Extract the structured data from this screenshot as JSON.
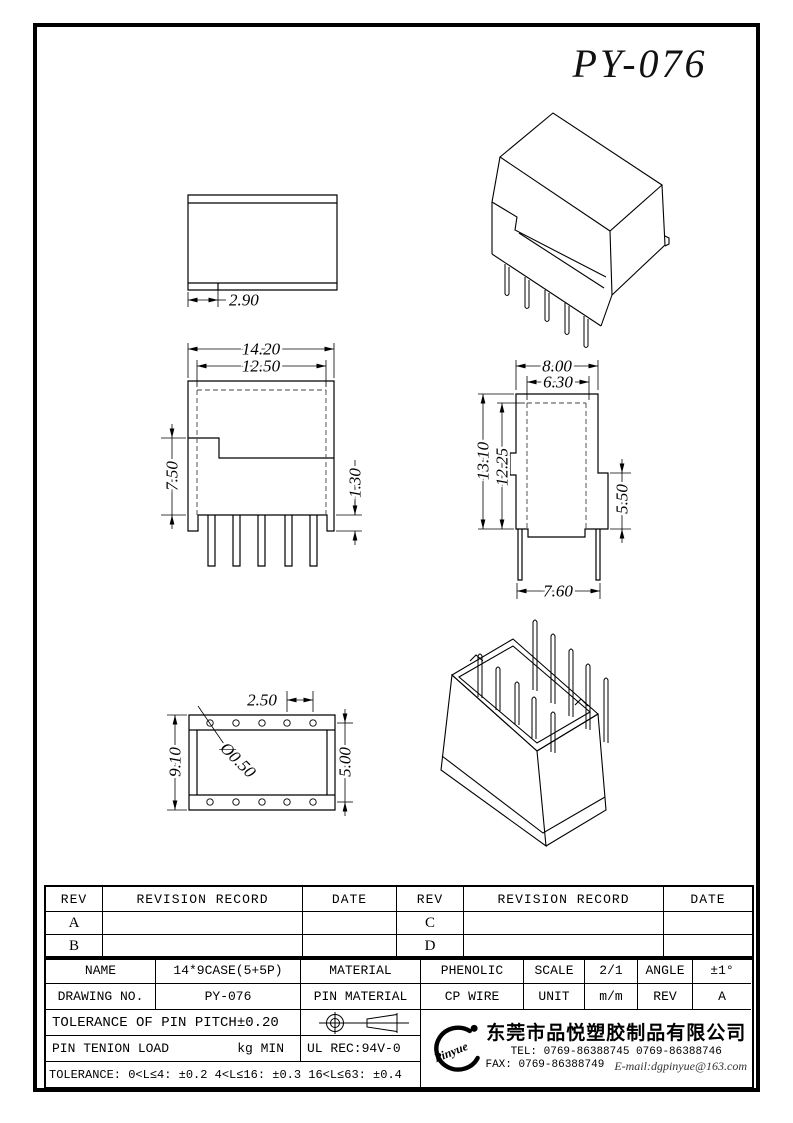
{
  "title": "PY-076",
  "views": {
    "top_view": {
      "step_width": "2.90"
    },
    "front_view": {
      "outer_width": "14.20",
      "inner_width": "12.50",
      "left_height": "7.50",
      "lip_height": "1.30"
    },
    "side_view": {
      "outer_width": "8.00",
      "inner_width": "6.30",
      "total_height": "13.10",
      "inner_height": "12.25",
      "right_height": "5.50",
      "pin_span": "7.60"
    },
    "bottom_view": {
      "pin_pitch": "2.50",
      "hole_diameter": "Ø0.50",
      "height": "9.10",
      "row_span": "5.00"
    }
  },
  "revision_table": {
    "headers": [
      "REV",
      "REVISION RECORD",
      "DATE",
      "REV",
      "REVISION RECORD",
      "DATE"
    ],
    "rows": [
      [
        "A",
        "",
        "",
        "C",
        "",
        ""
      ],
      [
        "B",
        "",
        "",
        "D",
        "",
        ""
      ]
    ]
  },
  "title_block": {
    "name_label": "NAME",
    "name_value": "14*9CASE(5+5P)",
    "material_label": "MATERIAL",
    "material_value": "PHENOLIC",
    "scale_label": "SCALE",
    "scale_value": "2/1",
    "angle_label": "ANGLE",
    "angle_value": "±1°",
    "drawing_no_label": "DRAWING NO.",
    "drawing_no_value": "PY-076",
    "pin_material_label": "PIN MATERIAL",
    "pin_material_value": "CP WIRE",
    "unit_label": "UNIT",
    "unit_value": "m/m",
    "rev_label": "REV",
    "rev_value": "A",
    "pin_pitch_tolerance": "TOLERANCE OF PIN PITCH±0.20",
    "pin_tension_label": "PIN TENION LOAD",
    "pin_tension_unit": "kg MIN",
    "ul_rec": "UL REC:94V-0",
    "tolerance_note": "TOLERANCE: 0<L≤4: ±0.2  4<L≤16: ±0.3  16<L≤63: ±0.4"
  },
  "company": {
    "logo_text": "Pinyue",
    "name": "东莞市品悦塑胶制品有限公司",
    "tel": "TEL: 0769-86388745    0769-86388746",
    "fax": "FAX: 0769-86388749",
    "email": "E-mail:dgpinyue@163.com"
  }
}
